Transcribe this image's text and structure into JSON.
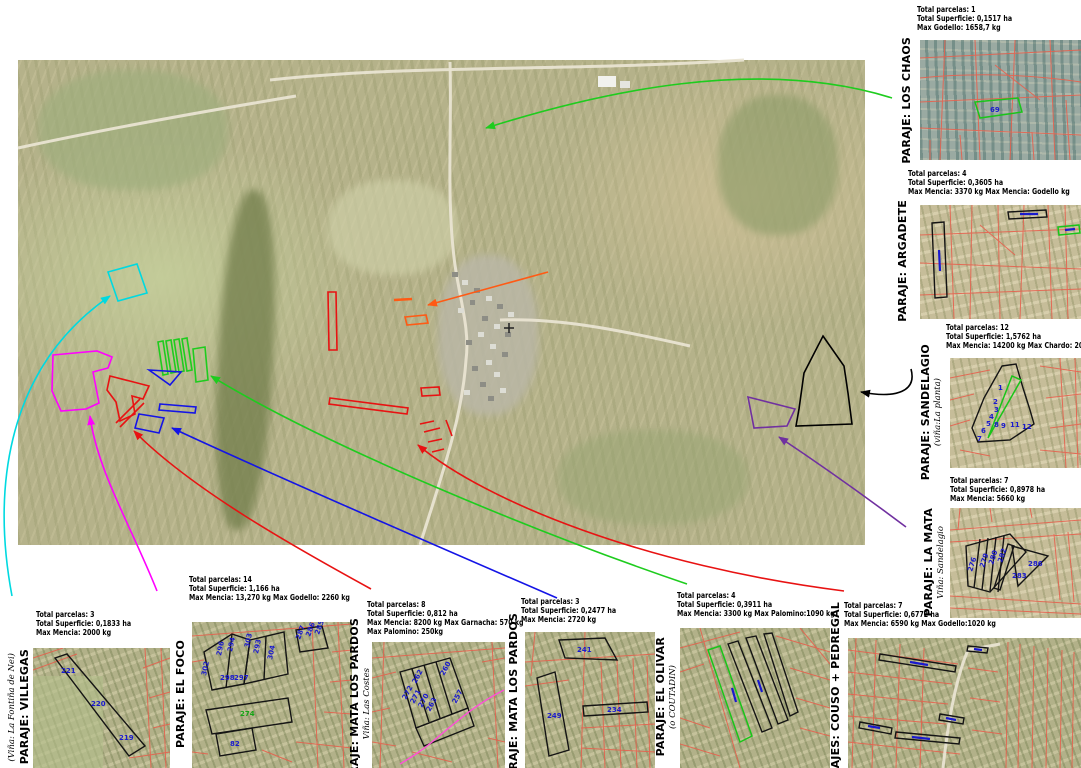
{
  "colors": {
    "cyan": "#00d9e0",
    "magenta": "#ff00ff",
    "red": "#e81212",
    "green": "#1ecc1e",
    "blue": "#1414e6",
    "orange": "#ff5a14",
    "purple": "#7030a0",
    "black": "#000000",
    "parcel_line": "#e5604e",
    "parcel_number": "#1a1acd"
  },
  "panels": {
    "los_chaos": {
      "label": "PARAJE: LOS CHAOS",
      "stats": [
        "Total parcelas: 1",
        "Total Superficie: 0,1517 ha",
        "Max Godello: 1658,7 kg"
      ],
      "parcels": [
        "69"
      ]
    },
    "argadete": {
      "label": "PARAJE: ARGADETE",
      "stats": [
        "Total parcelas: 4",
        "Total Superficie: 0,3605 ha",
        "Max Mencia: 3370 kg Max Mencia: Godello kg"
      ],
      "parcels": []
    },
    "sandelagio": {
      "label": "PARAJE: SANDELAGIO",
      "sublabel": "(viña:La planta)",
      "stats": [
        "Total parcelas: 12",
        "Total Superficie: 1,5762 ha",
        "Max Mencia: 14200 kg Max Chardo: 2000 kg"
      ],
      "parcels": [
        "1",
        "2",
        "3",
        "4",
        "5",
        "6",
        "7",
        "8",
        "9",
        "11",
        "12"
      ]
    },
    "la_mata": {
      "label": "PARAJE: LA MATA",
      "sublabel": "Viña: Sandelagio",
      "stats": [
        "Total parcelas: 7",
        "Total Superficie: 0,8978 ha",
        "Max Mencia: 5660 kg"
      ],
      "parcels": [
        "276",
        "279",
        "280",
        "282",
        "283",
        "286"
      ]
    },
    "villegas": {
      "label": "PARAJE: VILLEGAS",
      "sublabel": "(Viña: La Fontiña de Nei)",
      "stats": [
        "Total parcelas: 3",
        "Total Superficie: 0,1833 ha",
        "Max Mencia: 2000 kg"
      ],
      "parcels": [
        "221",
        "220",
        "219"
      ]
    },
    "el_foco": {
      "label": "PARAJE: EL FOCO",
      "stats": [
        "Total parcelas: 14",
        "Total Superficie: 1,166 ha",
        "Max Mencia: 13,270 kg Max Godello: 2260 kg"
      ],
      "parcels": [
        "302",
        "296",
        "294",
        "303",
        "293",
        "298",
        "297",
        "304",
        "287",
        "286",
        "285",
        "274",
        "82"
      ]
    },
    "mata_los_pardos_costes": {
      "label": "PARAJE: MATA LOS PARDOS",
      "sublabel": "Viña: Las Costes",
      "stats": [
        "Total parcelas: 8",
        "Total Superficie: 0,812 ha",
        "Max Mencia: 8200 kg Max Garnacha: 570 kg",
        "Max Palomino: 250kg"
      ],
      "parcels": [
        "272",
        "271",
        "270",
        "263",
        "262",
        "260",
        "257"
      ]
    },
    "mata_los_pardos": {
      "label": "PARAJE: MATA LOS PARDOS",
      "stats": [
        "Total parcelas: 3",
        "Total Superficie: 0,2477 ha",
        "Max Mencia: 2720 kg"
      ],
      "parcels": [
        "241",
        "249",
        "234"
      ]
    },
    "el_olivar": {
      "label": "PARAJE: EL OLIVAR",
      "sublabel": "(o COUTADIN)",
      "stats": [
        "Total parcelas: 4",
        "Total Superficie: 0,3911 ha",
        "Max Mencia: 3300 kg Max Palomino:1090 kg"
      ],
      "parcels": []
    },
    "couso_pedregal": {
      "label": "PARAJES: COUSO + PEDREGAL",
      "stats": [
        "Total parcelas: 7",
        "Total Superficie: 0,6772 ha",
        "Max Mencia: 6590 kg Max Godello:1020 kg"
      ],
      "parcels": []
    }
  }
}
